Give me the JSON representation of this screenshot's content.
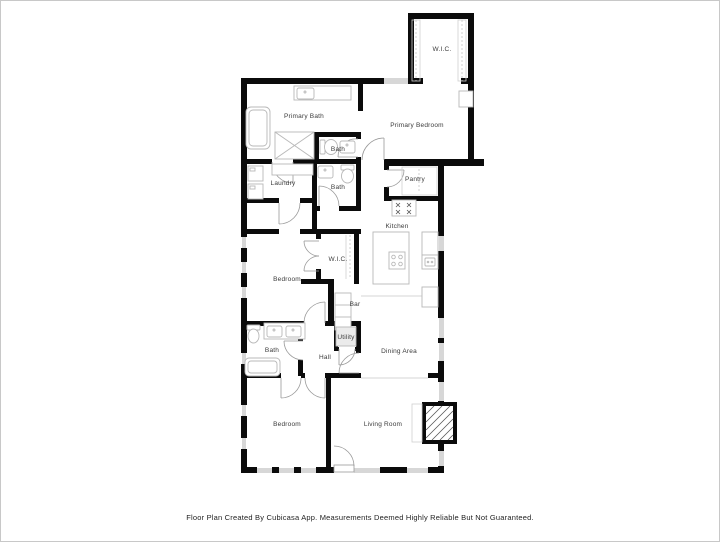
{
  "footer": {
    "disclaimer": "Floor Plan Created By Cubicasa App. Measurements Deemed Highly Reliable But Not Guaranteed."
  },
  "palette": {
    "wall": "#0b0b0b",
    "window": "#d7d7d7",
    "door_arc": "#9a9a9a",
    "fixture": "#b8b8b8",
    "label_text": "#3b3b3b",
    "background": "#ffffff",
    "page_border": "#c8c8c8"
  },
  "rooms": [
    {
      "id": "wic-top",
      "label": "W.I.C.",
      "x": 441,
      "y": 50
    },
    {
      "id": "primary-bath",
      "label": "Primary Bath",
      "x": 303,
      "y": 117
    },
    {
      "id": "primary-bedroom",
      "label": "Primary Bedroom",
      "x": 416,
      "y": 126
    },
    {
      "id": "bath-upper",
      "label": "Bath",
      "x": 337,
      "y": 150
    },
    {
      "id": "laundry",
      "label": "Laundry",
      "x": 282,
      "y": 184
    },
    {
      "id": "bath-mid",
      "label": "Bath",
      "x": 337,
      "y": 188
    },
    {
      "id": "pantry",
      "label": "Pantry",
      "x": 414,
      "y": 180
    },
    {
      "id": "kitchen",
      "label": "Kitchen",
      "x": 396,
      "y": 227
    },
    {
      "id": "bedroom-mid",
      "label": "Bedroom",
      "x": 286,
      "y": 280
    },
    {
      "id": "wic-mid",
      "label": "W.I.C.",
      "x": 337,
      "y": 260
    },
    {
      "id": "bar",
      "label": "Bar",
      "x": 354,
      "y": 305
    },
    {
      "id": "utility",
      "label": "Utility",
      "x": 345,
      "y": 338
    },
    {
      "id": "bath-lower",
      "label": "Bath",
      "x": 271,
      "y": 351
    },
    {
      "id": "hall",
      "label": "Hall",
      "x": 324,
      "y": 358
    },
    {
      "id": "dining-area",
      "label": "Dining Area",
      "x": 398,
      "y": 352
    },
    {
      "id": "bedroom-lower",
      "label": "Bedroom",
      "x": 286,
      "y": 425
    },
    {
      "id": "living-room",
      "label": "Living Room",
      "x": 382,
      "y": 425
    }
  ]
}
